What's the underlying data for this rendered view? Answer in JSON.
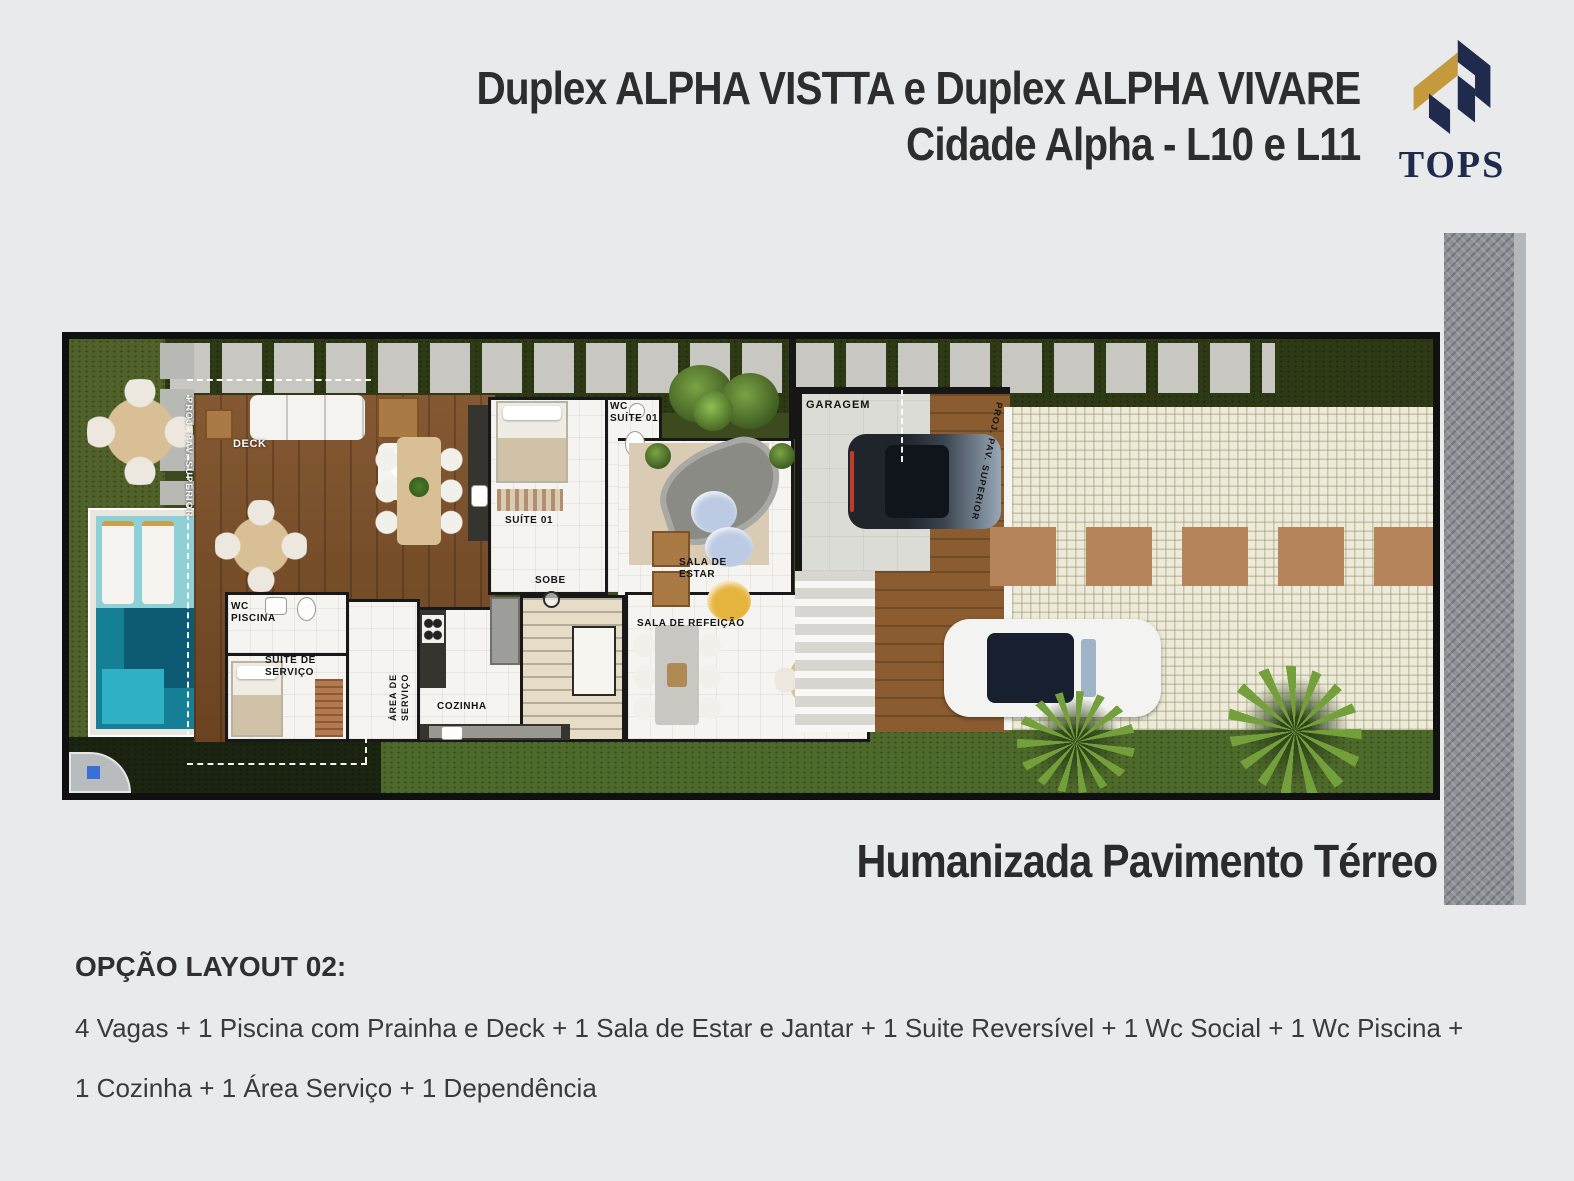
{
  "header": {
    "title_line1": "Duplex ALPHA VISTTA e Duplex ALPHA VIVARE",
    "title_line2": "Cidade Alpha - L10 e L11"
  },
  "brand": {
    "name": "TOPS",
    "navy": "#1f2a4d",
    "gold": "#c49a3c"
  },
  "plan": {
    "caption": "Humanizada Pavimento Térreo",
    "labels": {
      "proj_pav_superior_left": "PROJ. PAV. SUPERIOR",
      "proj_pav_superior_right": "PROJ. PAV. SUPERIOR",
      "deck": "DECK",
      "garagem": "GARAGEM",
      "wc_piscina": "WC PISCINA",
      "suite_servico": "SUÍTE DE SERVIÇO",
      "area_servico": "ÁREA DE SERVIÇO",
      "cozinha": "COZINHA",
      "sobe": "SOBE",
      "suite_01": "SUÍTE 01",
      "wc_suite_01": "WC SUÍTE 01",
      "sala_estar": "SALA DE ESTAR",
      "sala_refeicao": "SALA DE REFEIÇÃO"
    },
    "colors": {
      "pool_teal": "#157f96",
      "grass_green": "#3c4a1d",
      "wood_brown": "#7c4e26"
    }
  },
  "footer": {
    "heading": "OPÇÃO LAYOUT 02:",
    "line_1": "4 Vagas + 1 Piscina com Prainha e Deck + 1 Sala de Estar e Jantar + 1 Suite Reversível + 1 Wc Social + 1 Wc Piscina +",
    "line_2": "1 Cozinha + 1 Área Serviço + 1 Dependência"
  }
}
